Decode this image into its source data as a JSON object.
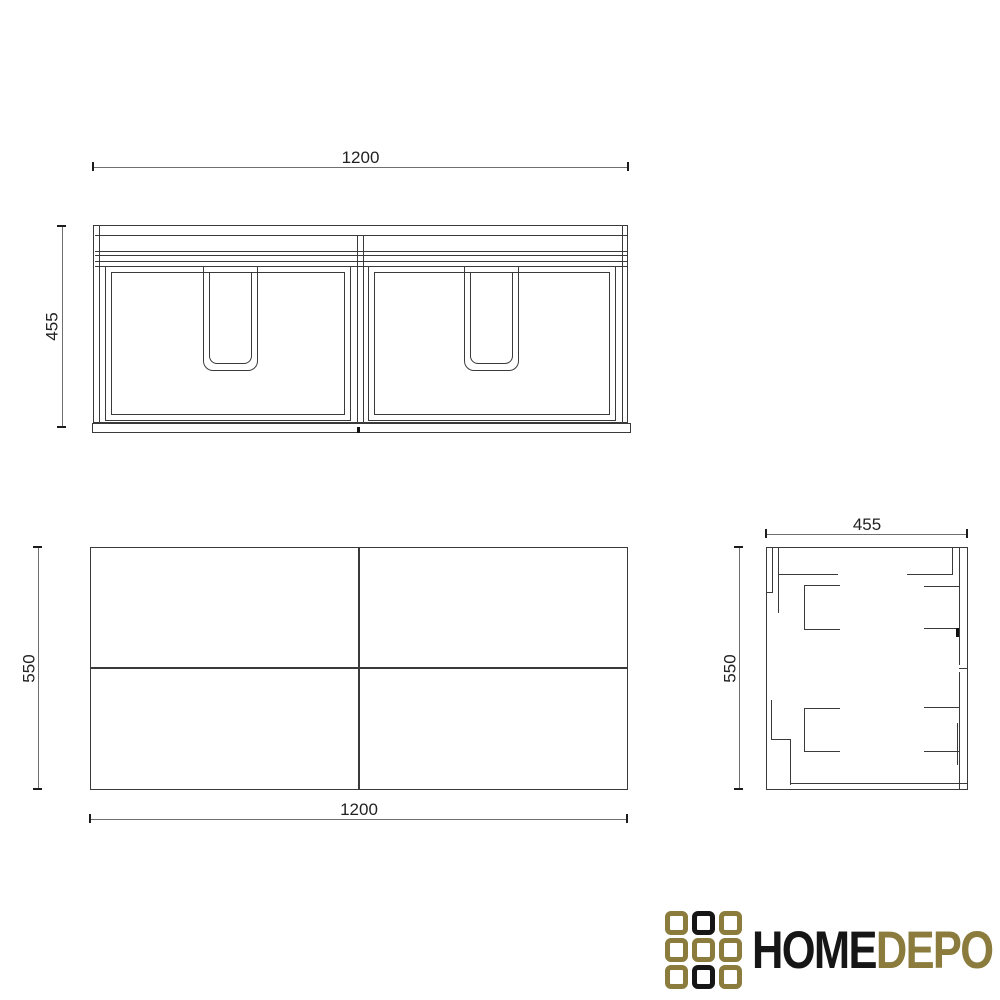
{
  "dimensions": {
    "front_width": "1200",
    "front_height": "455",
    "plan_width": "1200",
    "plan_depth": "550",
    "side_width": "455",
    "side_height": "550"
  },
  "logo": {
    "text_primary": "HOME",
    "text_secondary": "DEPO",
    "grid_pattern": [
      [
        "gold",
        "black",
        "gold"
      ],
      [
        "gold",
        "gold",
        "gold"
      ],
      [
        "gold",
        "black",
        "gold"
      ]
    ]
  },
  "colors": {
    "drawing_line": "#3a3a3a",
    "dimension_line": "#6f6f6f",
    "dimension_text": "#222222",
    "logo_gold": "#8b7c3e",
    "logo_black": "#161616"
  }
}
